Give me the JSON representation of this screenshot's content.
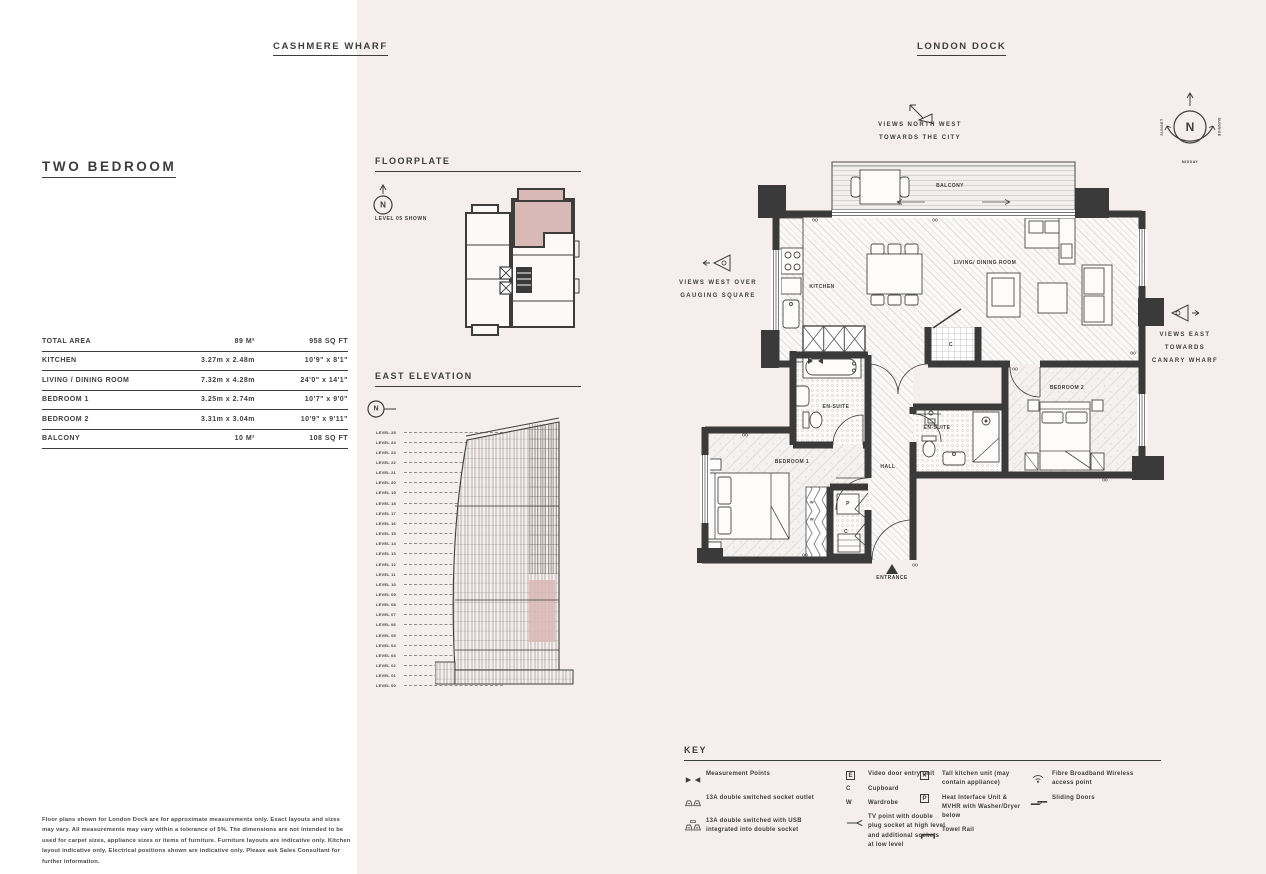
{
  "colors": {
    "page_bg": "#f5eeec",
    "panel_bg": "#ffffff",
    "ink": "#3d3d3d",
    "wall": "#3a3a3a",
    "highlight": "#d9b9b5"
  },
  "header": {
    "left_project": "CASHMERE WHARF",
    "right_project": "LONDON DOCK"
  },
  "unit": {
    "title": "TWO BEDROOM"
  },
  "area_table": {
    "total_label": "TOTAL AREA",
    "total_metric": "89 M²",
    "total_imperial": "958 SQ FT",
    "rows": [
      {
        "label": "KITCHEN",
        "metric": "3.27m x 2.48m",
        "imperial": "10'9\" x 8'1\""
      },
      {
        "label": "LIVING / DINING ROOM",
        "metric": "7.32m x 4.28m",
        "imperial": "24'0\" x 14'1\""
      },
      {
        "label": "BEDROOM 1",
        "metric": "3.25m x 2.74m",
        "imperial": "10'7\" x 9'0\""
      },
      {
        "label": "BEDROOM 2",
        "metric": "3.31m x 3.04m",
        "imperial": "10'9\" x 9'11\""
      },
      {
        "label": "BALCONY",
        "metric": "10 M²",
        "imperial": "108 SQ FT"
      }
    ]
  },
  "floorplate": {
    "heading": "FLOORPLATE",
    "compass_letter": "N",
    "note": "LEVEL 05 SHOWN"
  },
  "elevation": {
    "heading": "EAST ELEVATION",
    "compass_letter": "N",
    "levels": [
      "LEVEL 25",
      "LEVEL 24",
      "LEVEL 23",
      "LEVEL 22",
      "LEVEL 21",
      "LEVEL 20",
      "LEVEL 19",
      "LEVEL 18",
      "LEVEL 17",
      "LEVEL 16",
      "LEVEL 15",
      "LEVEL 14",
      "LEVEL 13",
      "LEVEL 12",
      "LEVEL 11",
      "LEVEL 10",
      "LEVEL 09",
      "LEVEL 08",
      "LEVEL 07",
      "LEVEL 06",
      "LEVEL 05",
      "LEVEL 04",
      "LEVEL 03",
      "LEVEL 02",
      "LEVEL 01",
      "LEVEL 00"
    ]
  },
  "plan": {
    "room_labels": {
      "balcony": "BALCONY",
      "kitchen": "KITCHEN",
      "living_dining": "LIVING/ DINING ROOM",
      "bedroom1": "BEDROOM 1",
      "bedroom2": "BEDROOM 2",
      "ensuite1": "EN-SUITE",
      "ensuite2": "EN-SUITE",
      "hall": "HALL",
      "entrance": "ENTRANCE",
      "cupboard1": "C",
      "cupboard2": "C",
      "heat_unit": "P",
      "wardrobe_w1": "W",
      "wardrobe_w2": "W"
    },
    "views": {
      "north_west": [
        "VIEWS NORTH WEST",
        "TOWARDS THE CITY"
      ],
      "west": [
        "VIEWS WEST OVER",
        "GAUGING SQUARE"
      ],
      "east": [
        "VIEWS EAST",
        "TOWARDS",
        "CANARY WHARF"
      ]
    },
    "compass": {
      "letter": "N",
      "west_label": "SUNSET",
      "east_label": "SUNRISE",
      "south_label": "MIDDAY"
    }
  },
  "key": {
    "heading": "KEY",
    "columns": [
      {
        "items": [
          {
            "icon": "measurement-points-icon",
            "label": "Measurement Points"
          },
          {
            "icon": "double-socket-icon",
            "label": "13A double switched socket outlet"
          },
          {
            "icon": "usb-socket-icon",
            "label": "13A double switched with USB integrated into double socket"
          }
        ]
      },
      {
        "items": [
          {
            "icon": "video-entry-icon",
            "glyph": "E",
            "boxed": true,
            "label": "Video door entry unit"
          },
          {
            "icon": "cupboard-icon",
            "glyph": "C",
            "label": "Cupboard"
          },
          {
            "icon": "wardrobe-icon",
            "glyph": "W",
            "label": "Wardrobe"
          },
          {
            "icon": "tv-point-icon",
            "label": "TV point with double plug socket at high level and additional sockets at low level"
          }
        ]
      },
      {
        "items": [
          {
            "icon": "tall-kitchen-unit-icon",
            "glyph": "✕",
            "boxed": true,
            "label": "Tall kitchen unit (may contain appliance)"
          },
          {
            "icon": "heat-interface-icon",
            "glyph": "P",
            "boxed": true,
            "label": "Heat Interface Unit & MVHR with Washer/Dryer below"
          },
          {
            "icon": "towel-rail-icon",
            "label": "Towel Rail"
          }
        ]
      },
      {
        "items": [
          {
            "icon": "wifi-icon",
            "label": "Fibre Broadband Wireless access point"
          },
          {
            "icon": "sliding-doors-icon",
            "label": "Sliding Doors"
          }
        ]
      }
    ]
  },
  "footer": {
    "disclaimer": "Floor plans shown for London Dock are for approximate measurements only. Exact layouts and sizes may vary. All measurements may vary within a tolerance of 5%. The dimensions are not intended to be used for carpet sizes, appliance sizes or items of furniture. Furniture layouts are indicative only. Kitchen layout indicative only. Electrical positions shown are indicative only. Please ask Sales Consultant for further information."
  }
}
